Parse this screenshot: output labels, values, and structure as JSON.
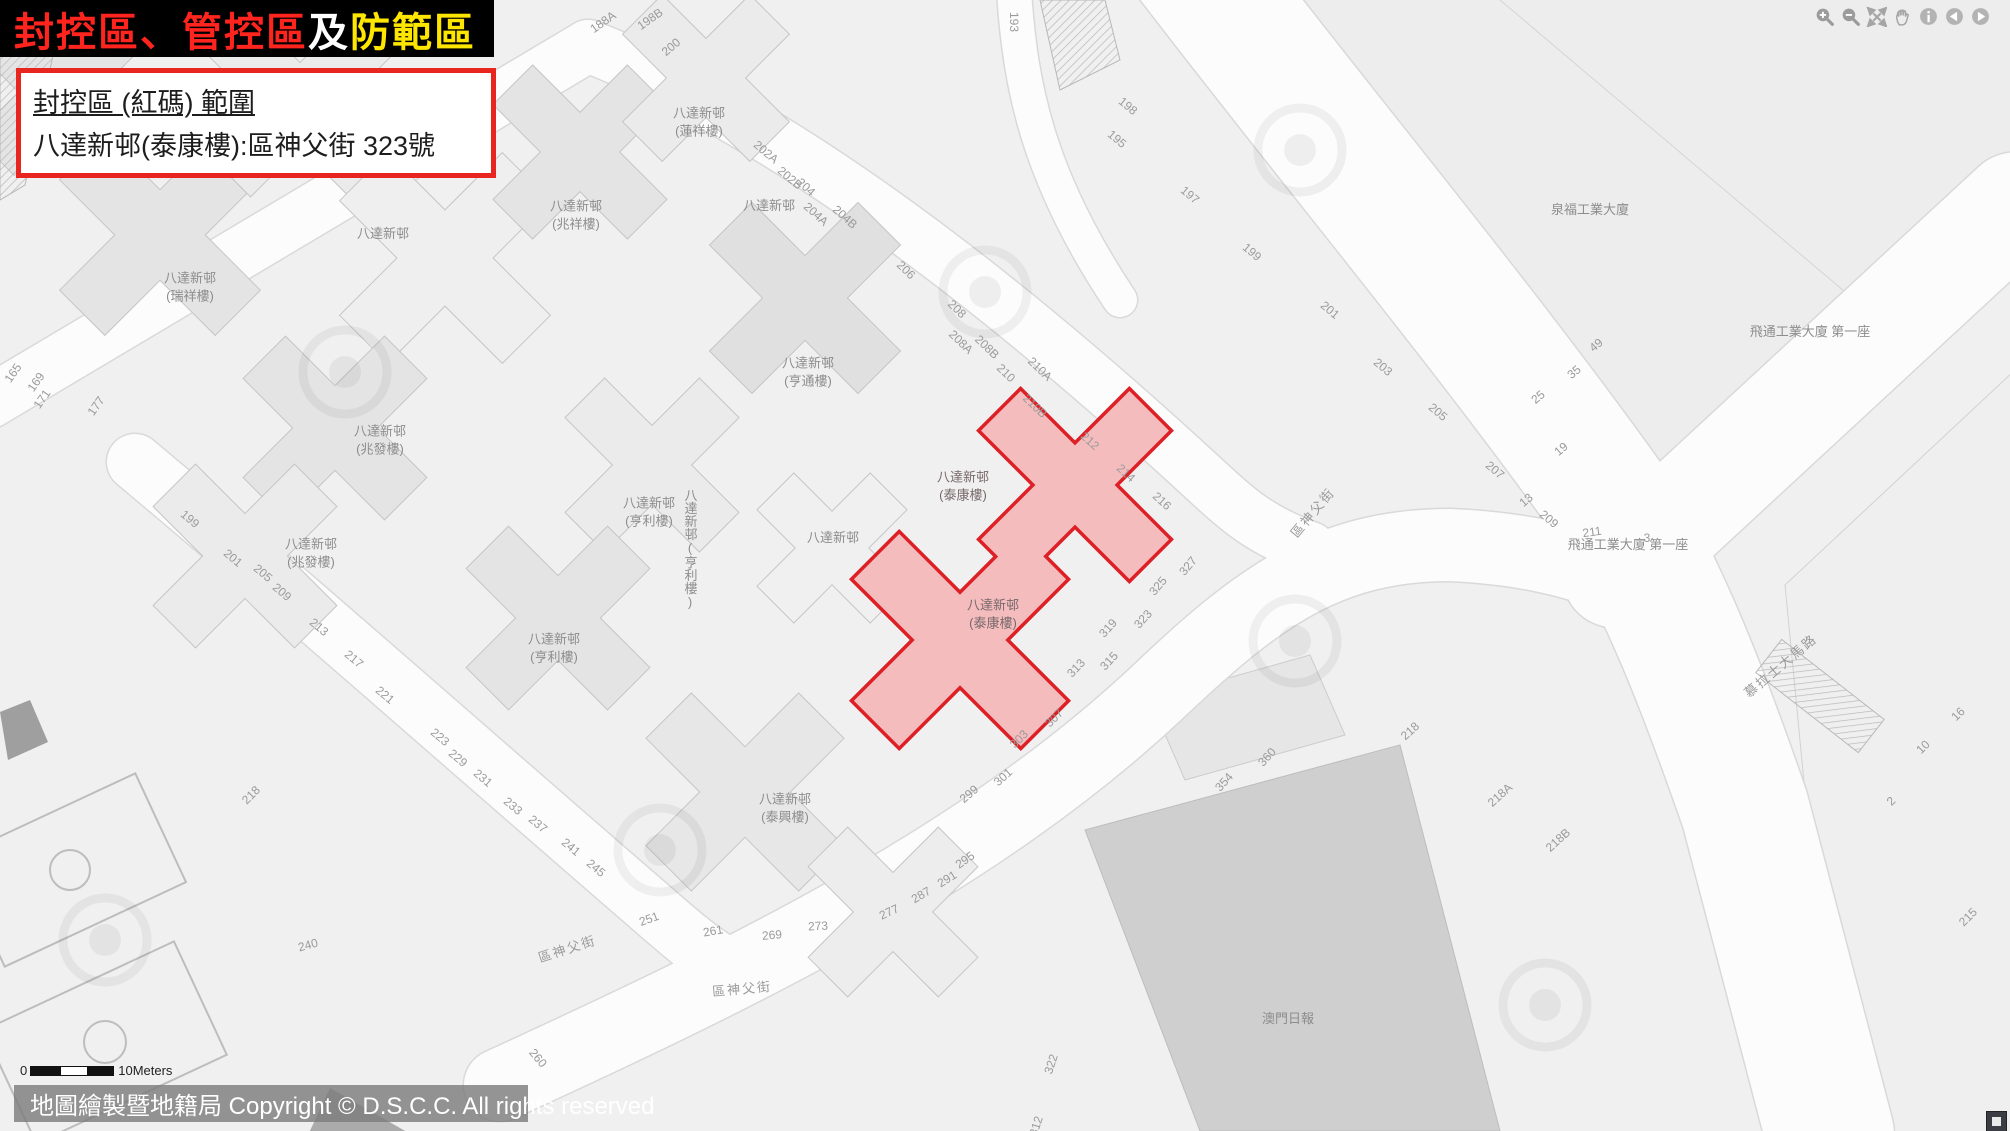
{
  "title": {
    "parts": [
      {
        "text": "封控區、管控區",
        "color": "#ff241e"
      },
      {
        "text": "及",
        "color": "#ffffff"
      },
      {
        "text": "防範區",
        "color": "#ffe600"
      }
    ]
  },
  "info_box": {
    "line1": "封控區 (紅碼) 範圍",
    "line2": "八達新邨(泰康樓):區神父街 323號"
  },
  "toolbar": {
    "icons": [
      "zoom-in",
      "zoom-out",
      "fullscreen",
      "pan-hand",
      "info",
      "previous-view",
      "next-view"
    ]
  },
  "map": {
    "red_zone": {
      "name": "八達新邨 (泰康樓)",
      "fill": "#f5bcbe",
      "border": "#dd2026",
      "labels": [
        {
          "text": "八達新邨\n(泰康樓)",
          "x": 963,
          "y": 486
        },
        {
          "text": "八達新邨\n(泰康樓)",
          "x": 993,
          "y": 614
        }
      ]
    },
    "building_labels": [
      {
        "text": "八達新邨\n(瑞祥樓)",
        "x": 190,
        "y": 287
      },
      {
        "text": "八達新邨",
        "x": 383,
        "y": 234
      },
      {
        "text": "八達新邨\n(兆祥樓)",
        "x": 576,
        "y": 215
      },
      {
        "text": "八達新邨\n(蓮祥樓)",
        "x": 699,
        "y": 122
      },
      {
        "text": "八達新邨",
        "x": 769,
        "y": 206
      },
      {
        "text": "八達新邨\n(亨通樓)",
        "x": 808,
        "y": 372
      },
      {
        "text": "八達新邨\n(兆發樓)",
        "x": 380,
        "y": 440
      },
      {
        "text": "八達新邨\n(兆發樓)",
        "x": 311,
        "y": 553
      },
      {
        "text": "八達新邨\n(亨利樓)",
        "x": 649,
        "y": 512
      },
      {
        "text": "八達新邨(亨利樓)",
        "x": 690,
        "y": 549,
        "vertical": true
      },
      {
        "text": "八達新邨",
        "x": 833,
        "y": 538
      },
      {
        "text": "八達新邨\n(亨利樓)",
        "x": 554,
        "y": 648
      },
      {
        "text": "八達新邨\n(泰興樓)",
        "x": 785,
        "y": 808
      },
      {
        "text": "泉福工業大廈",
        "x": 1590,
        "y": 210
      },
      {
        "text": "飛通工業大廈 第一座",
        "x": 1810,
        "y": 332
      },
      {
        "text": "飛通工業大廈 第一座",
        "x": 1628,
        "y": 545
      },
      {
        "text": "澳門日報",
        "x": 1288,
        "y": 1019
      }
    ],
    "street_name_labels": [
      {
        "t": "區神父街",
        "x": 1312,
        "y": 512,
        "r": -50
      },
      {
        "t": "區神父街",
        "x": 742,
        "y": 988,
        "r": -5
      },
      {
        "t": "區神父街",
        "x": 567,
        "y": 948,
        "r": -18
      },
      {
        "t": "慕拉士大馬路",
        "x": 1780,
        "y": 665,
        "r": -40
      }
    ],
    "street_numbers": [
      {
        "t": "188A",
        "x": 603,
        "y": 22,
        "r": -35
      },
      {
        "t": "198B",
        "x": 650,
        "y": 19,
        "r": -35
      },
      {
        "t": "200",
        "x": 671,
        "y": 47,
        "r": -40
      },
      {
        "t": "193",
        "x": 1014,
        "y": 22,
        "r": 90
      },
      {
        "t": "202A",
        "x": 766,
        "y": 152,
        "r": 40
      },
      {
        "t": "202B",
        "x": 790,
        "y": 178,
        "r": 40
      },
      {
        "t": "204",
        "x": 806,
        "y": 187,
        "r": 42
      },
      {
        "t": "204A",
        "x": 816,
        "y": 214,
        "r": 42
      },
      {
        "t": "204B",
        "x": 845,
        "y": 217,
        "r": 42
      },
      {
        "t": "206",
        "x": 906,
        "y": 270,
        "r": 44
      },
      {
        "t": "208",
        "x": 957,
        "y": 309,
        "r": 44
      },
      {
        "t": "208A",
        "x": 961,
        "y": 342,
        "r": 44
      },
      {
        "t": "208B",
        "x": 987,
        "y": 347,
        "r": 44
      },
      {
        "t": "210",
        "x": 1006,
        "y": 373,
        "r": 44
      },
      {
        "t": "210A",
        "x": 1040,
        "y": 369,
        "r": 44
      },
      {
        "t": "210B",
        "x": 1035,
        "y": 406,
        "r": 44
      },
      {
        "t": "212",
        "x": 1090,
        "y": 441,
        "r": 42
      },
      {
        "t": "214",
        "x": 1126,
        "y": 473,
        "r": 42
      },
      {
        "t": "216",
        "x": 1162,
        "y": 501,
        "r": 42
      },
      {
        "t": "195",
        "x": 1117,
        "y": 139,
        "r": 40
      },
      {
        "t": "198",
        "x": 1128,
        "y": 106,
        "r": 40
      },
      {
        "t": "197",
        "x": 1190,
        "y": 195,
        "r": 40
      },
      {
        "t": "199",
        "x": 1252,
        "y": 252,
        "r": 40
      },
      {
        "t": "201",
        "x": 1330,
        "y": 310,
        "r": 40
      },
      {
        "t": "203",
        "x": 1383,
        "y": 367,
        "r": 40
      },
      {
        "t": "205",
        "x": 1438,
        "y": 412,
        "r": 40
      },
      {
        "t": "207",
        "x": 1495,
        "y": 470,
        "r": 40
      },
      {
        "t": "209",
        "x": 1549,
        "y": 519,
        "r": 40
      },
      {
        "t": "49",
        "x": 1596,
        "y": 345,
        "r": -40
      },
      {
        "t": "35",
        "x": 1574,
        "y": 372,
        "r": -40
      },
      {
        "t": "25",
        "x": 1538,
        "y": 397,
        "r": -40
      },
      {
        "t": "19",
        "x": 1561,
        "y": 449,
        "r": -40
      },
      {
        "t": "13",
        "x": 1526,
        "y": 500,
        "r": -40
      },
      {
        "t": "211",
        "x": 1592,
        "y": 532,
        "r": -8
      },
      {
        "t": "3",
        "x": 1647,
        "y": 538,
        "r": 0
      },
      {
        "t": "165",
        "x": 13,
        "y": 373,
        "r": -55
      },
      {
        "t": "169",
        "x": 36,
        "y": 382,
        "r": -55
      },
      {
        "t": "171",
        "x": 42,
        "y": 399,
        "r": -55
      },
      {
        "t": "177",
        "x": 96,
        "y": 406,
        "r": -55
      },
      {
        "t": "199",
        "x": 190,
        "y": 519,
        "r": 40
      },
      {
        "t": "201",
        "x": 233,
        "y": 558,
        "r": 40
      },
      {
        "t": "205",
        "x": 263,
        "y": 573,
        "r": 40
      },
      {
        "t": "209",
        "x": 282,
        "y": 592,
        "r": 40
      },
      {
        "t": "213",
        "x": 319,
        "y": 627,
        "r": 40
      },
      {
        "t": "217",
        "x": 354,
        "y": 659,
        "r": 40
      },
      {
        "t": "221",
        "x": 385,
        "y": 695,
        "r": 40
      },
      {
        "t": "223",
        "x": 440,
        "y": 737,
        "r": 40
      },
      {
        "t": "229",
        "x": 458,
        "y": 758,
        "r": 40
      },
      {
        "t": "231",
        "x": 483,
        "y": 778,
        "r": 40
      },
      {
        "t": "233",
        "x": 513,
        "y": 806,
        "r": 40
      },
      {
        "t": "237",
        "x": 538,
        "y": 824,
        "r": 40
      },
      {
        "t": "241",
        "x": 571,
        "y": 847,
        "r": 40
      },
      {
        "t": "245",
        "x": 596,
        "y": 868,
        "r": 40
      },
      {
        "t": "218",
        "x": 251,
        "y": 795,
        "r": -45
      },
      {
        "t": "240",
        "x": 308,
        "y": 945,
        "r": -15
      },
      {
        "t": "260",
        "x": 538,
        "y": 1058,
        "r": 50
      },
      {
        "t": "251",
        "x": 649,
        "y": 919,
        "r": -20
      },
      {
        "t": "261",
        "x": 713,
        "y": 931,
        "r": -10
      },
      {
        "t": "269",
        "x": 772,
        "y": 935,
        "r": -5
      },
      {
        "t": "273",
        "x": 818,
        "y": 926,
        "r": -3
      },
      {
        "t": "277",
        "x": 889,
        "y": 912,
        "r": -25
      },
      {
        "t": "287",
        "x": 921,
        "y": 895,
        "r": -30
      },
      {
        "t": "291",
        "x": 947,
        "y": 879,
        "r": -32
      },
      {
        "t": "295",
        "x": 965,
        "y": 860,
        "r": -35
      },
      {
        "t": "299",
        "x": 969,
        "y": 794,
        "r": -40
      },
      {
        "t": "301",
        "x": 1003,
        "y": 777,
        "r": -42
      },
      {
        "t": "303",
        "x": 1019,
        "y": 739,
        "r": -45
      },
      {
        "t": "307",
        "x": 1054,
        "y": 718,
        "r": -45
      },
      {
        "t": "313",
        "x": 1076,
        "y": 668,
        "r": -47
      },
      {
        "t": "315",
        "x": 1109,
        "y": 661,
        "r": -47
      },
      {
        "t": "319",
        "x": 1108,
        "y": 628,
        "r": -48
      },
      {
        "t": "323",
        "x": 1143,
        "y": 619,
        "r": -48
      },
      {
        "t": "325",
        "x": 1158,
        "y": 586,
        "r": -50
      },
      {
        "t": "327",
        "x": 1188,
        "y": 566,
        "r": -50
      },
      {
        "t": "354",
        "x": 1224,
        "y": 782,
        "r": -48
      },
      {
        "t": "360",
        "x": 1267,
        "y": 757,
        "r": -48
      },
      {
        "t": "218",
        "x": 1410,
        "y": 731,
        "r": -42
      },
      {
        "t": "218A",
        "x": 1500,
        "y": 795,
        "r": -42
      },
      {
        "t": "218B",
        "x": 1558,
        "y": 840,
        "r": -42
      },
      {
        "t": "322",
        "x": 1051,
        "y": 1064,
        "r": -72
      },
      {
        "t": "312",
        "x": 1036,
        "y": 1126,
        "r": -72
      },
      {
        "t": "2",
        "x": 1891,
        "y": 801,
        "r": -45
      },
      {
        "t": "10",
        "x": 1923,
        "y": 747,
        "r": -45
      },
      {
        "t": "16",
        "x": 1958,
        "y": 714,
        "r": -45
      },
      {
        "t": "215",
        "x": 1968,
        "y": 917,
        "r": -45
      }
    ]
  },
  "scale_bar": {
    "zero": "0",
    "units": "10Meters"
  },
  "footer": {
    "copyright": "地圖繪製暨地籍局 Copyright © D.S.C.C. All rights reserved"
  },
  "colors": {
    "map_bg": "#f0f0f0",
    "road": "#fcfcfc",
    "road_casing": "#d9d9d9",
    "building": "#e6e6e6",
    "building_outline": "#c5c5c5",
    "zone_fill": "#f5bcbe",
    "zone_border": "#dd2026",
    "accent": "#e8251f",
    "banner_bg": "#000000"
  }
}
